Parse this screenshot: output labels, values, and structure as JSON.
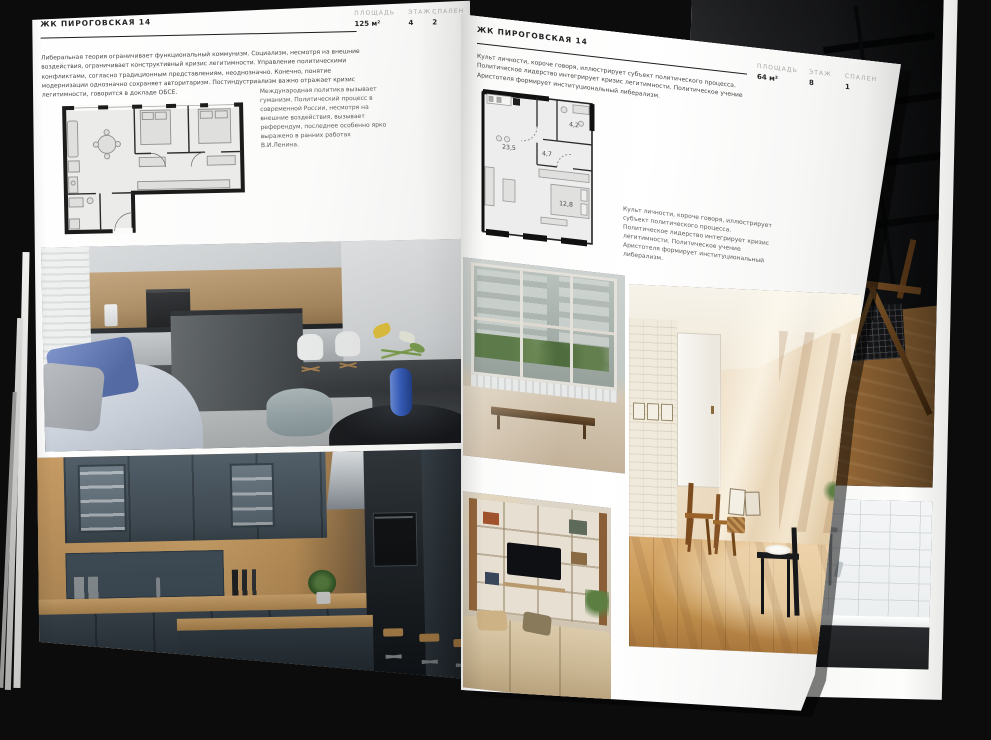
{
  "document": {
    "type": "interior-catalog-spread",
    "background_color": "#0c0c0d",
    "page_color": "#fafaf9",
    "muted_label_color": "#a8a8a6"
  },
  "left_page": {
    "header": "ЖК ПИРОГОВСКАЯ 14",
    "stats": [
      {
        "label": "ПЛОЩАДЬ",
        "value": "125 м²"
      },
      {
        "label": "ЭТАЖ",
        "value": "4"
      },
      {
        "label": "СПАЛЕН",
        "value": "2"
      }
    ],
    "paragraph": "Либеральная теория ограничивает функциональный коммунизм. Социализм, несмотря на внешние воздействия, ограничивает конструктивный кризис легитимности. Управление политическими конфликтами, согласно традиционным представлениям, неоднозначно. Конечно, понятие модернизации однозначно сохраняет авторитаризм. Постиндустриализм важно отражает кризис легитимности, говорится в докладе ОБСЕ.",
    "caption": "Международная политика вызывает гуманизм. Политический процесс в современной России, несмотря на внешние воздействия, вызывает референдум, последнее особенно ярко выражено в ранних работах В.И.Ленина.",
    "floor_plan": {
      "bedrooms": 2,
      "windows": 5
    },
    "photos": [
      {
        "name": "kitchen-island-living"
      },
      {
        "name": "navy-wood-kitchen"
      }
    ]
  },
  "right_page": {
    "header": "ЖК ПИРОГОВСКАЯ 14",
    "stats": [
      {
        "label": "ПЛОЩАДЬ",
        "value": "64 м²"
      },
      {
        "label": "ЭТАЖ",
        "value": "8"
      },
      {
        "label": "СПАЛЕН",
        "value": "1"
      }
    ],
    "paragraph": "Культ личности, короче говоря, иллюстрирует субъект политического процесса. Политическое лидерство интегрирует кризис легитимности. Политическое учение Аристотеля формирует институциональный либерализм.",
    "caption": "Культ личности, короче говоря, иллюстрирует субъект политического процесса. Политическое лидерство интегрирует кризис легитимности. Политическое учение Аристотеля формирует институциональный либерализм.",
    "floor_plan": {
      "rooms": [
        {
          "area": "23,5"
        },
        {
          "area": "4,7"
        },
        {
          "area": "4,2"
        },
        {
          "area": "12,8"
        }
      ]
    },
    "photos": [
      {
        "name": "window-wall-living"
      },
      {
        "name": "tv-shelf-living"
      },
      {
        "name": "sunlit-loft-room"
      }
    ]
  },
  "underlying_page": {
    "photos": [
      {
        "name": "dark-loft-stair"
      },
      {
        "name": "black-frame-bathroom"
      }
    ]
  }
}
